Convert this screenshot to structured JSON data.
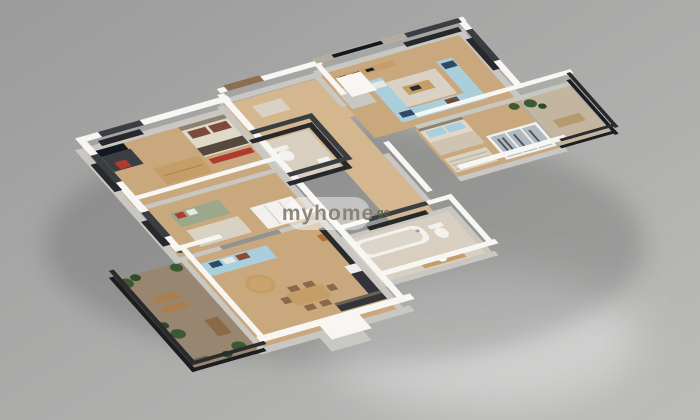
{
  "watermark": {
    "brand": "myhome",
    "domain": ".ge"
  },
  "scene": {
    "description": "3D isometric render of an apartment floor plan on a gray studio background",
    "view": "isometric top-down"
  },
  "palette": {
    "background_top": "#9b9b9b",
    "background_bottom": "#bcbcba",
    "wall_top": "#f7f6f3",
    "wall_face": "#c9c7c2",
    "wall_dark": "#3a3d42",
    "wall_dark_face": "#26282c",
    "floor_wood": "#c9a87e",
    "floor_wood_light": "#d5b78f",
    "floor_tile": "#d8cfc0",
    "floor_balcony": "#c4b59e",
    "floor_terrace": "#998670",
    "sofa_blue": "#a9cfdc",
    "sofa_green": "#9aa98c",
    "accent_red": "#b03a2c",
    "pillow_navy": "#2e4a66",
    "wood_furniture": "#c49e66",
    "wood_dark": "#8a6a48",
    "kitchen_dark": "#33343a",
    "tv_black": "#121922",
    "railing": "#2b2b2d",
    "plant": "#3a5a36",
    "plant_dark": "#2e4c2b",
    "rug": "#d9d2c4",
    "bed_linen": "#e0d8c9",
    "headboard": "#8d8172",
    "glass": "#aeb9c0",
    "stone_wall": "#b5ab9c",
    "watermark_pill": "rgba(255,255,255,0.45)",
    "watermark_text": "#857b6e",
    "watermark_domain": "#5a6248"
  },
  "rooms": [
    {
      "label": "Bedroom"
    },
    {
      "label": "Second bedroom"
    },
    {
      "label": "Entry hall"
    },
    {
      "label": "WC"
    },
    {
      "label": "Hallway"
    },
    {
      "label": "Living room"
    },
    {
      "label": "Master bedroom"
    },
    {
      "label": "Balcony"
    },
    {
      "label": "Bathroom"
    },
    {
      "label": "Kitchen and dining"
    },
    {
      "label": "Terrace"
    }
  ]
}
